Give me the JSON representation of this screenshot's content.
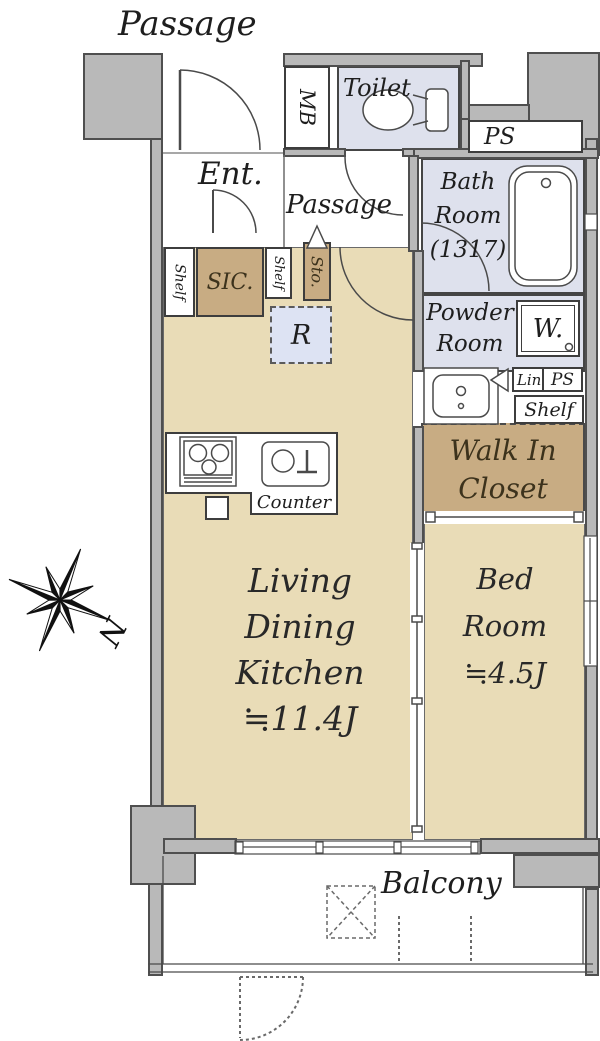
{
  "outside": {
    "passage_top": "Passage",
    "balcony": "Balcony"
  },
  "compass": {
    "n": "N"
  },
  "rooms": {
    "entrance": {
      "label": "Ent."
    },
    "inner_passage": {
      "label": "Passage"
    },
    "toilet": {
      "label": "Toilet"
    },
    "bath": {
      "lines": [
        "Bath",
        "Room",
        "(1317)"
      ]
    },
    "powder": {
      "lines": [
        "Powder",
        "Room"
      ]
    },
    "walk_in_closet": {
      "lines": [
        "Walk In",
        "Closet"
      ]
    },
    "ldk": {
      "lines": [
        "Living",
        "Dining",
        "Kitchen",
        "≒11.4J"
      ],
      "size_tatami": "11.4J"
    },
    "bedroom": {
      "lines": [
        "Bed",
        "Room",
        "≒4.5J"
      ],
      "size_tatami": "4.5J"
    }
  },
  "fixtures": {
    "mb": "MB",
    "ps_top": "PS",
    "ps_mid": "PS",
    "washer": "W.",
    "linen": "Lin.",
    "shelf_left": "Shelf",
    "shelf_mid": "Shelf",
    "shelf_right": "Shelf",
    "sic": "SIC.",
    "storage": "Sto.",
    "refrigerator": "R",
    "counter": "Counter"
  },
  "colors": {
    "wall_gray": "#b9b9b9",
    "wall_line": "#4f4f4f",
    "room_tan": "#e9dcb7",
    "closet_tan": "#c8ac83",
    "wet_room_lavender": "#dee1ed",
    "fridge_blue": "#dde3f3"
  }
}
